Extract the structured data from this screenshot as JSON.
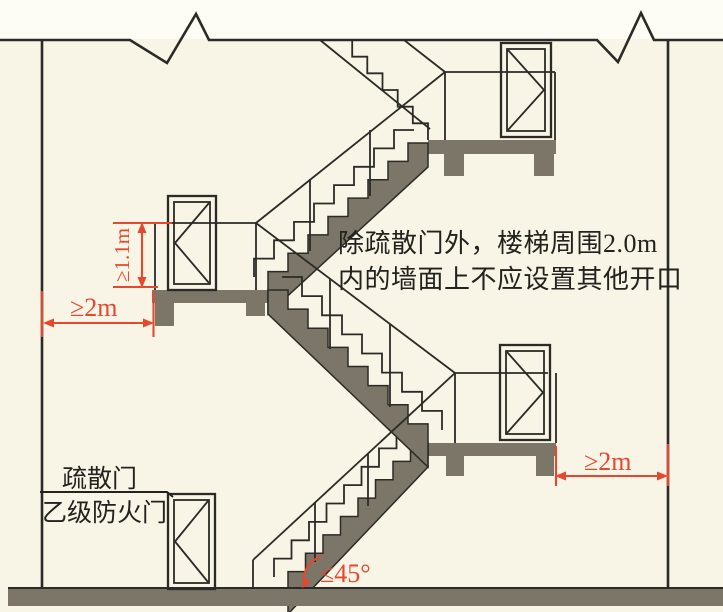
{
  "diagram": {
    "note": {
      "line1": "除疏散门外，楼梯周围2.0m",
      "line2": "内的墙面上不应设置其他开口"
    },
    "dimensions": {
      "door_width": "≥1.1m",
      "left_clearance": "≥2m",
      "right_clearance": "≥2m",
      "stair_angle": "≤45°"
    },
    "labels": {
      "evacuation_door": "疏散门",
      "fire_door": "乙级防火门"
    },
    "colors": {
      "annotation_red": "#e8472f",
      "concrete_gray": "#7b7667",
      "line_black": "#2b2a26",
      "background": "#f8f5e6",
      "sky": "#fdfcf5"
    }
  }
}
